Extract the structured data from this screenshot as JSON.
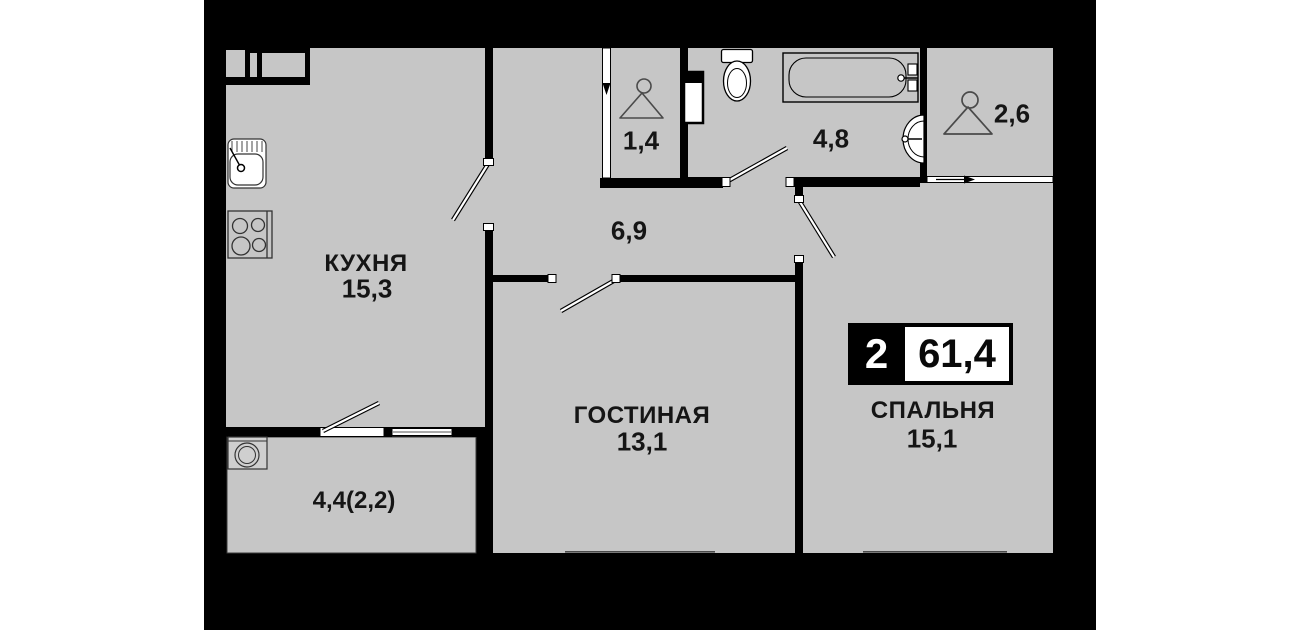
{
  "badge": {
    "room_count": "2",
    "total_area": "61,4"
  },
  "rooms": {
    "kitchen": {
      "name": "КУХНЯ",
      "area": "15,3"
    },
    "living": {
      "name": "ГОСТИНАЯ",
      "area": "13,1"
    },
    "bedroom": {
      "name": "СПАЛЬНЯ",
      "area": "15,1"
    },
    "hallway": {
      "area": "6,9"
    },
    "closet_small": {
      "area": "1,4"
    },
    "bathroom": {
      "area": "4,8"
    },
    "closet_large": {
      "area": "2,6"
    },
    "balcony": {
      "area": "4,4(2,2)"
    }
  },
  "fixtures": [
    "kitchen-sink",
    "stove",
    "washing-machine",
    "toilet",
    "bathtub",
    "washbasin",
    "hanger",
    "hanger"
  ],
  "colors": {
    "canvas": "#000000",
    "floor": "#c6c6c6",
    "fixture": "#ffffff",
    "page": "#ffffff"
  }
}
